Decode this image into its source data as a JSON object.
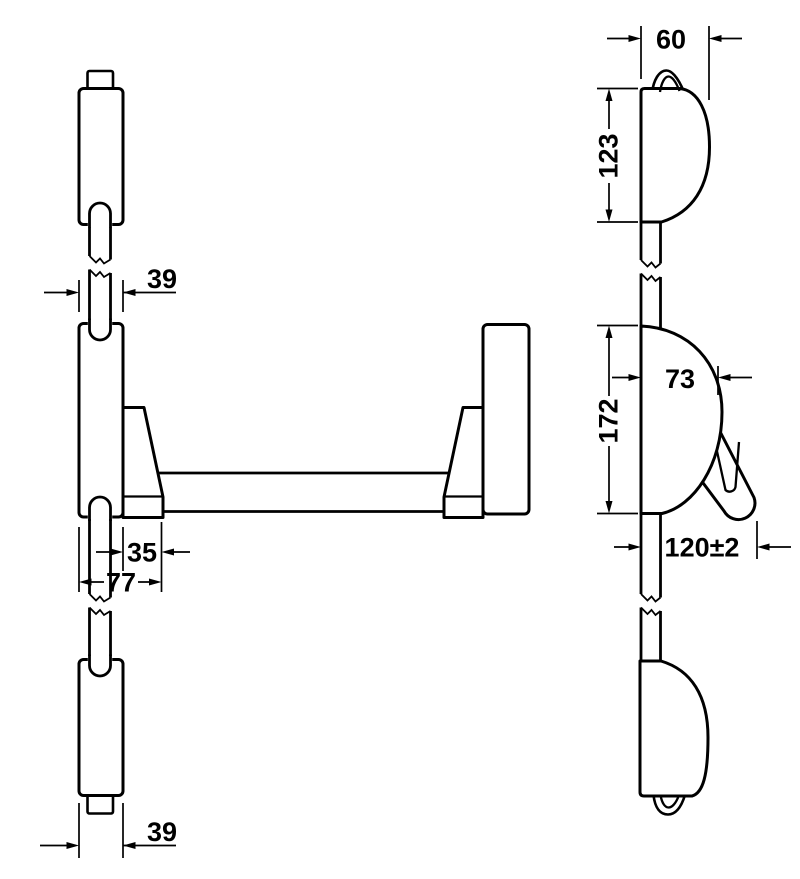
{
  "drawing": {
    "kind": "technical-dimension-drawing",
    "background_color": "#ffffff",
    "line_color": "#000000",
    "views": {
      "front": {
        "label": "front-view-vertical-rod-exit-device"
      },
      "side": {
        "label": "side-view-profile"
      }
    },
    "dims": {
      "d39top": "39",
      "d35": "35",
      "d77": "77",
      "d39bottom": "39",
      "d60": "60",
      "d123": "123",
      "d73": "73",
      "d172": "172",
      "d120": "120±2"
    }
  }
}
